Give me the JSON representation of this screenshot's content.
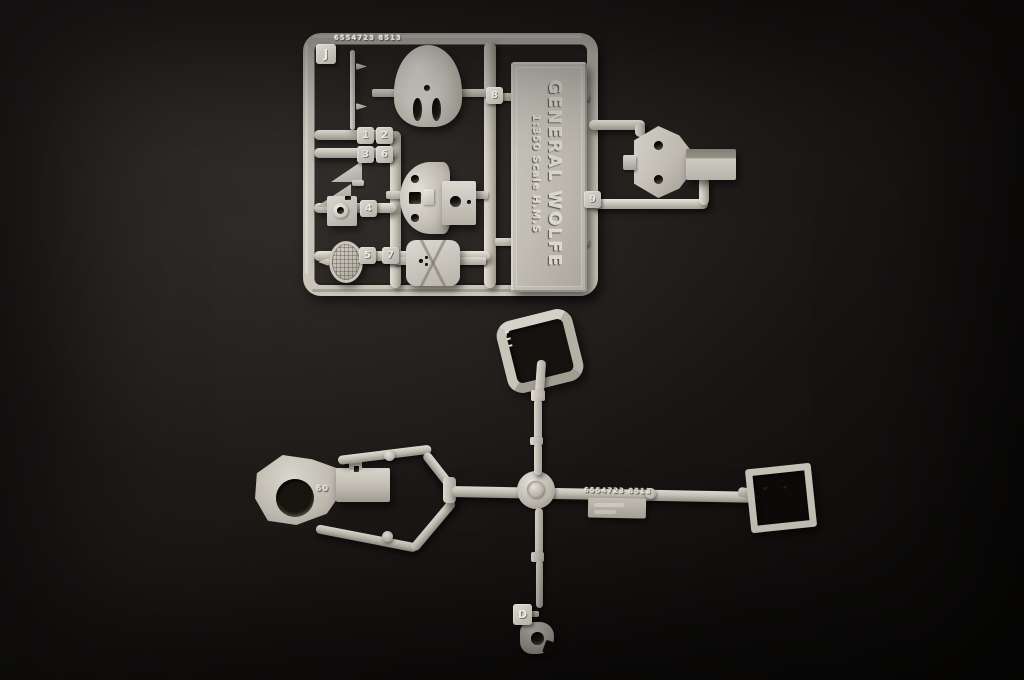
{
  "colors": {
    "background_dark": "#100e0d",
    "background_light": "#262322",
    "plastic_base": "#c8c4ba",
    "plastic_highlight": "#e8e5de",
    "plastic_shadow": "#958f85"
  },
  "sprue_j": {
    "letter": "J",
    "mold_code": "6554723 8513",
    "tabs": {
      "t1": "1",
      "t2": "2",
      "t3": "3",
      "t6": "6",
      "t4": "4",
      "t5": "5",
      "t7": "7",
      "t8": "8",
      "t9": "9"
    },
    "nameplate": {
      "title": "GENERAL  WOLFE",
      "subtitle": "1:350   Scale   H.M.S"
    }
  },
  "sprue_d": {
    "letter": "D",
    "mold_code": "6554723 8513",
    "part_mark": "60"
  }
}
